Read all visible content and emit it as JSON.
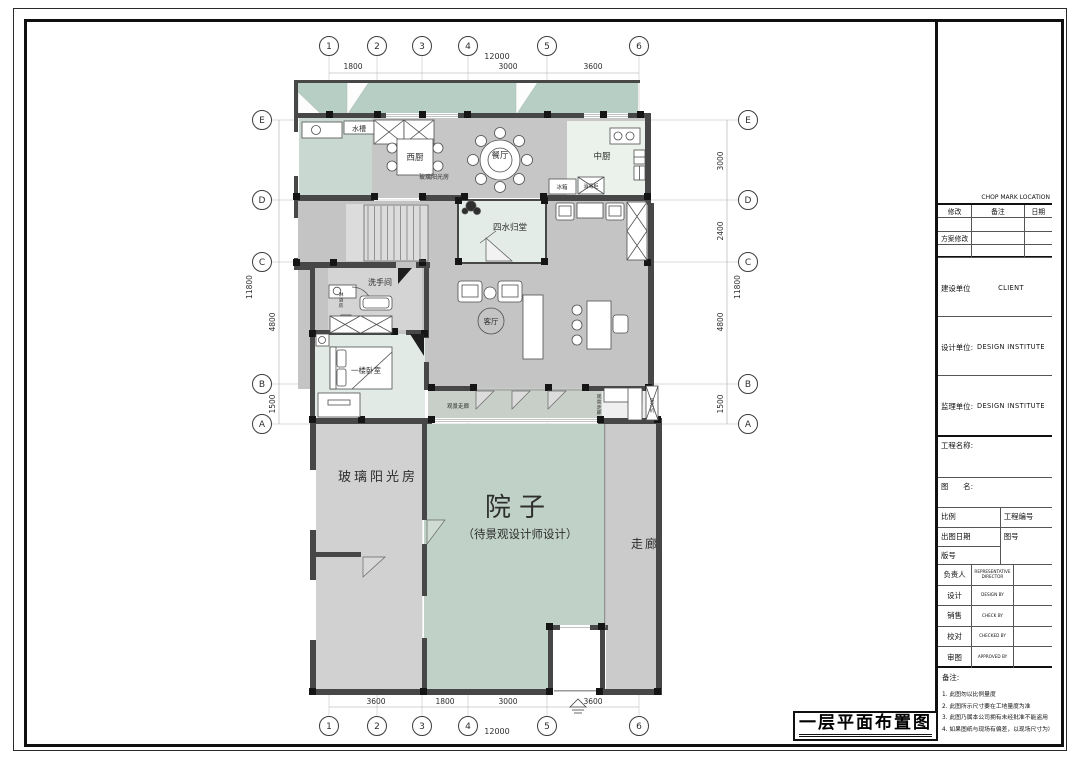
{
  "page": {
    "drawing_title": "一层平面布置图"
  },
  "grid": {
    "cols": [
      "1",
      "2",
      "3",
      "4",
      "5",
      "6"
    ],
    "rows": [
      "E",
      "D",
      "C",
      "B",
      "A"
    ]
  },
  "dims": {
    "top": [
      "1800",
      "3000",
      "3600",
      "12000"
    ],
    "bottom": [
      "3600",
      "1800",
      "3000",
      "3600",
      "12000"
    ],
    "left": [
      "11800",
      "4800",
      "1500"
    ],
    "right": [
      "3000",
      "2400",
      "11800",
      "4800",
      "1500"
    ]
  },
  "rooms": {
    "dining": "餐厅",
    "west_kitchen": "西厨",
    "chinese_kitchen": "中厨",
    "atrium": "四水归堂",
    "bathroom": "洗手间",
    "bedroom": "一楼卧室",
    "living": "客厅",
    "sunroom_top": "玻璃阳光房",
    "sunroom": "玻璃阳光房",
    "courtyard": "院子",
    "courtyard_note": "（待景观设计师设计）",
    "corridor": "走廊",
    "view_corridor": "观景走廊",
    "view_corridor_v": "观景走廊"
  },
  "labels": {
    "sink": "水槽",
    "fridge": "冰箱",
    "sterilizer": "消毒柜",
    "shower": "淋浴房",
    "laundry": "洗衣机"
  },
  "titleblock": {
    "chop_mark": "CHOP MARK LOCATION",
    "rev": {
      "modify": "修改",
      "remark": "备注",
      "date": "日期",
      "scheme": "方案修改"
    },
    "units": {
      "owner_label": "建设单位",
      "owner": "CLIENT",
      "design_label": "设计单位:",
      "design": "DESIGN INSTITUTE",
      "supervision_label": "监理单位:",
      "supervision": "DESIGN INSTITUTE"
    },
    "project_name_label": "工程名称:",
    "drawing_name_label": "图　　名:",
    "scale_label": "比例",
    "project_no_label": "工程编号",
    "date_label": "出图日期",
    "drawing_no_label": "图号",
    "version_label": "版号",
    "sign": [
      {
        "label": "负责人",
        "en": "REPRESENTATIVE DIRECTOR"
      },
      {
        "label": "设计",
        "en": "DESIGN BY"
      },
      {
        "label": "销售",
        "en": "CHECK BY"
      },
      {
        "label": "校对",
        "en": "CHECKED BY"
      },
      {
        "label": "审图",
        "en": "APPROVED BY"
      }
    ],
    "notes_label": "备注:"
  },
  "notes": [
    "1. 此图勿以比例量度",
    "2. 此图所示尺寸要在工地量度为准",
    "3. 此图乃属本公司拥有未经批准不能盗用",
    "4. 如果图纸与现场有偏差，以现场尺寸为准"
  ]
}
